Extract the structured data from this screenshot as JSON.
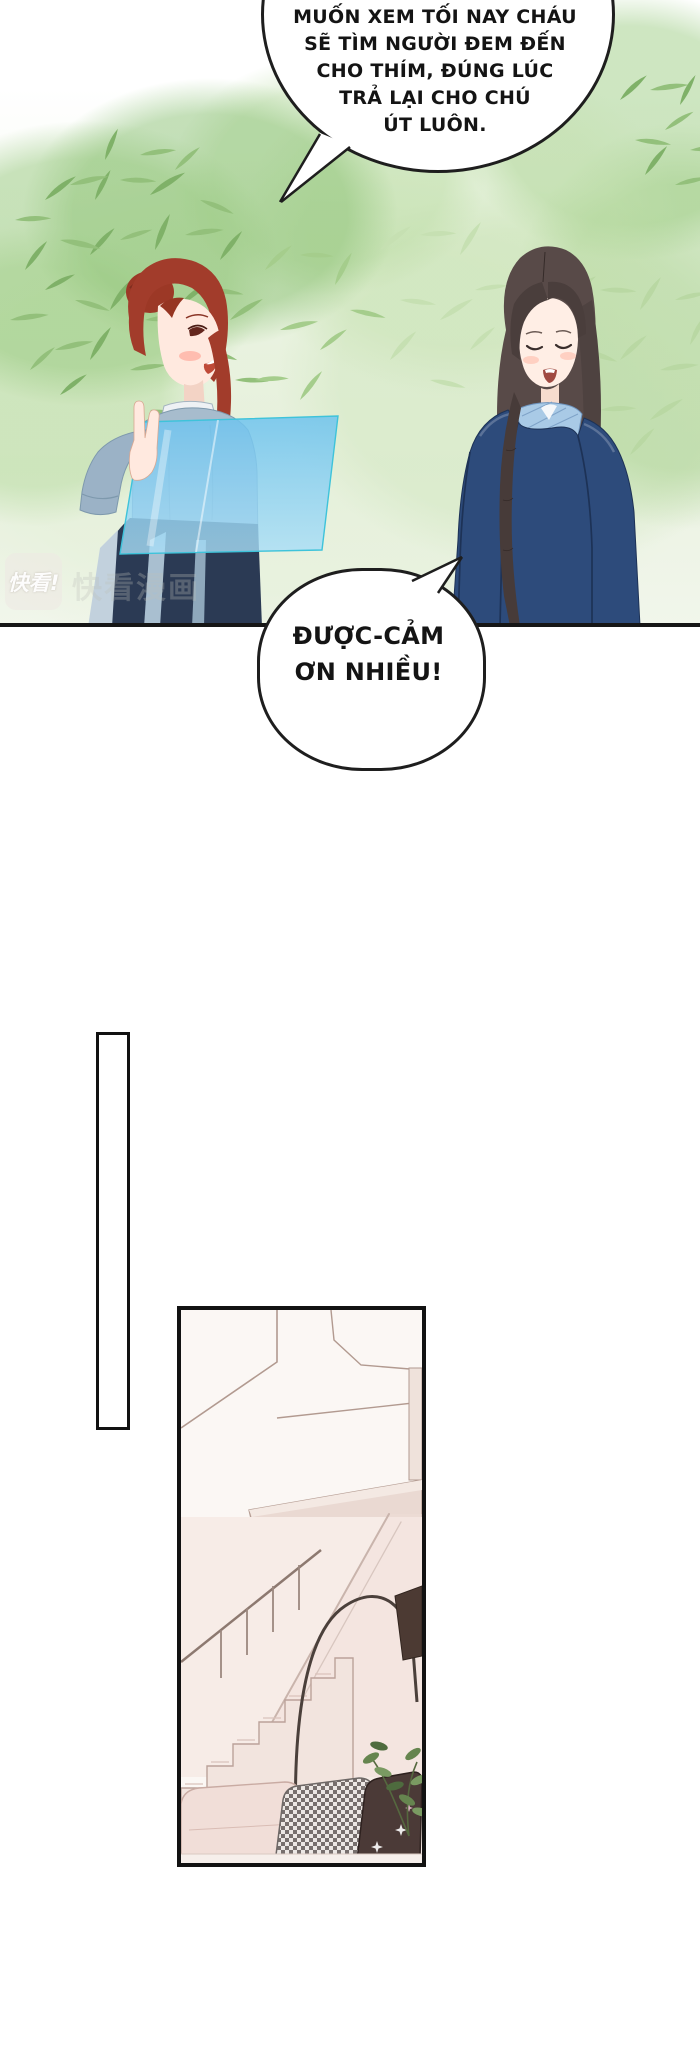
{
  "page": {
    "width": 700,
    "height": 2070,
    "background": "#ffffff"
  },
  "panel_garden": {
    "bubble_main": {
      "lines": [
        "MUỐN XEM TỐI NAY CHÁU",
        "SẼ TÌM NGƯỜI ĐEM ĐẾN",
        "CHO THÍM, ĐÚNG LÚC",
        "TRẢ LẠI CHO CHÚ",
        "ÚT LUÔN."
      ]
    },
    "bubble_reply": {
      "lines": [
        "ĐƯỢC-CẢM",
        "ƠN NHIỀU!"
      ]
    },
    "watermark": {
      "logo_text": "快看!",
      "ghost_text": "快看漫画"
    },
    "characters": [
      {
        "id": "red-haired-woman",
        "hair_color": "#a23c2b",
        "dress_color": "#a7bccd",
        "skirt_color": "#2b3a54"
      },
      {
        "id": "dark-haired-woman",
        "hair_color": "#584a48",
        "coat_color": "#2d4b7b",
        "collar_color": "#a9cae6"
      }
    ],
    "glass_pane_color": "#7cc9ef",
    "foliage_colors": [
      "#7fb168",
      "#93c07b",
      "#a5cd8c",
      "#b9d8a3",
      "#c6e0b2"
    ]
  },
  "panel_interior": {
    "elements": [
      "staircase",
      "glass-railing",
      "handrail",
      "arch-floor-lamp",
      "sofa",
      "houndstooth-pillow",
      "dark-pillow",
      "plant",
      "sparkles"
    ],
    "wall_color": "#f7ece7",
    "sofa_color": "#f1ded8",
    "dark_pillow_color": "#4b3a37"
  }
}
